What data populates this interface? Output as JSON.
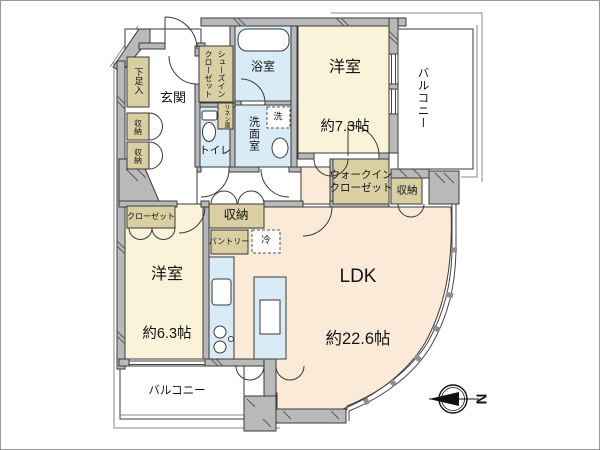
{
  "plan": {
    "rooms": {
      "bedroom1": {
        "name": "洋室",
        "size": "約7.3帖"
      },
      "bedroom2": {
        "name": "洋室",
        "size": "約6.3帖"
      },
      "ldk": {
        "name": "LDK",
        "size": "約22.6帖"
      },
      "bath": {
        "name": "浴室"
      },
      "washroom": {
        "name": "洗面室"
      },
      "toilet": {
        "name": "トイレ"
      },
      "entrance": {
        "name": "玄関"
      },
      "walk_in_closet": {
        "name": "ウォークイン\nクローゼット"
      },
      "shoes_in_closet": {
        "name": "シューズイン\nクローゼット"
      },
      "balcony_right": {
        "name": "バルコニー"
      },
      "balcony_bottom": {
        "name": "バルコニー"
      }
    },
    "fixtures": {
      "shoe_box": "下足入",
      "storage_left_1": "収納",
      "storage_left_2": "収納",
      "linen": "リネン庫",
      "washer": "洗",
      "storage_center": "収納",
      "pantry": "パントリー",
      "fridge": "冷",
      "closet": "クローゼット",
      "storage_right": "収納"
    },
    "compass": {
      "north": "N"
    },
    "colors": {
      "wall": "#b9b9b9",
      "cream": "#faf3da",
      "peach": "#fcead9",
      "blue": "#d9ebf7",
      "tan": "#d9cfa3",
      "line": "#3a3a3a"
    }
  }
}
